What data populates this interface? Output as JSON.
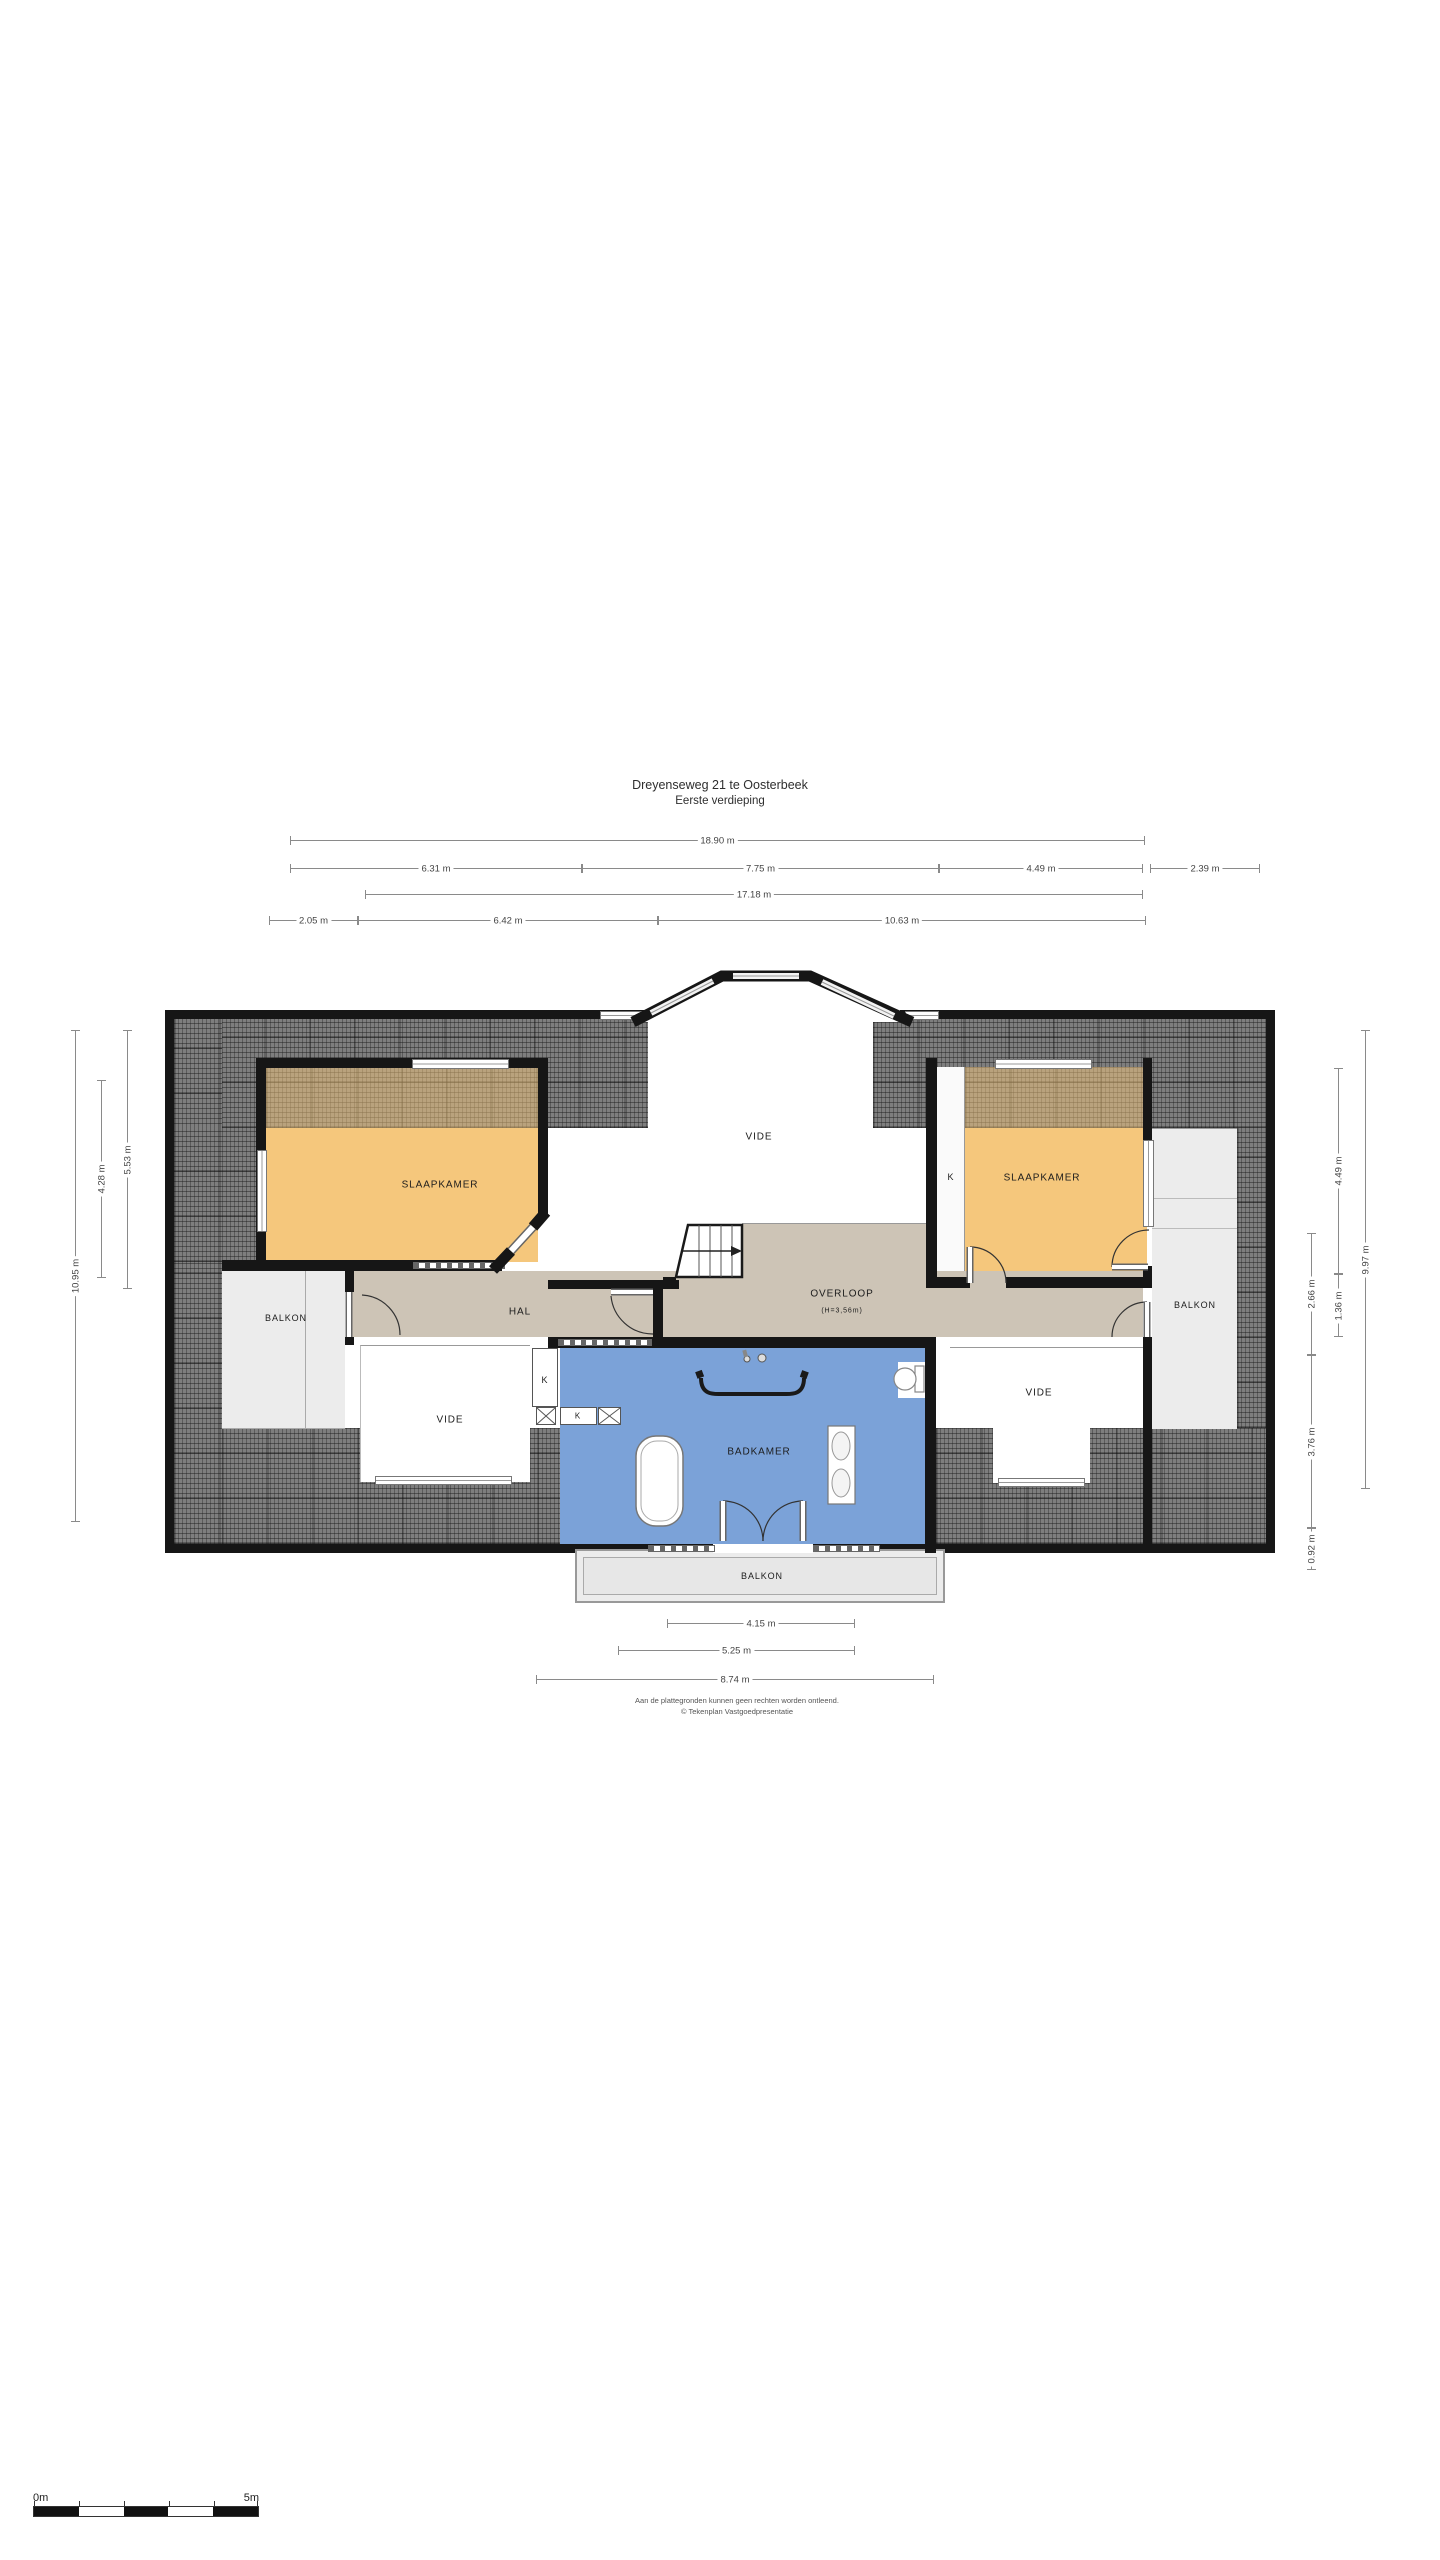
{
  "title": {
    "line1": "Dreyenseweg 21 te Oosterbeek",
    "line2": "Eerste verdieping"
  },
  "colors": {
    "wall": "#161616",
    "bedroom": "#f5c77c",
    "hall": "#cdc4b6",
    "bathroom": "#7ba2d8",
    "balcony": "#ececec",
    "roof_hatch": "#7e7e7e",
    "dim_line": "#8a8a8a",
    "label": "#1c1c1c"
  },
  "floorplan": {
    "room_labels": [
      {
        "name": "room-label-slaapkamer-left",
        "label": "SLAAPKAMER",
        "x": 440,
        "y": 1185
      },
      {
        "name": "room-label-vide-center",
        "label": "VIDE",
        "x": 759,
        "y": 1137
      },
      {
        "name": "room-label-slaapkamer-right",
        "label": "SLAAPKAMER",
        "x": 1042,
        "y": 1178
      },
      {
        "name": "room-label-hal",
        "label": "HAL",
        "x": 520,
        "y": 1312
      },
      {
        "name": "room-label-overloop",
        "label": "OVERLOOP",
        "x": 842,
        "y": 1294
      },
      {
        "name": "room-label-overloop-height",
        "label": "(H=3,56m)",
        "x": 842,
        "y": 1311,
        "size": 7
      },
      {
        "name": "room-label-badkamer",
        "label": "BADKAMER",
        "x": 759,
        "y": 1452
      },
      {
        "name": "room-label-vide-left",
        "label": "VIDE",
        "x": 450,
        "y": 1420
      },
      {
        "name": "room-label-vide-right",
        "label": "VIDE",
        "x": 1039,
        "y": 1393
      },
      {
        "name": "room-label-balkon-left",
        "label": "BALKON",
        "x": 286,
        "y": 1318,
        "size": 9
      },
      {
        "name": "room-label-balkon-right",
        "label": "BALKON",
        "x": 1195,
        "y": 1305,
        "size": 9
      },
      {
        "name": "room-label-balkon-bottom",
        "label": "BALKON",
        "x": 762,
        "y": 1576,
        "size": 9
      },
      {
        "name": "closet-label-right-bedroom",
        "label": "K",
        "x": 951,
        "y": 1177,
        "size": 9
      },
      {
        "name": "closet-label-bathroom-1",
        "label": "K",
        "x": 545,
        "y": 1380,
        "size": 9
      },
      {
        "name": "closet-label-bathroom-2",
        "label": "K",
        "x": 578,
        "y": 1416,
        "size": 8
      }
    ],
    "dimensions": [
      {
        "label": "18.90 m",
        "o": "h",
        "x": 290,
        "y": 840,
        "len": 855
      },
      {
        "label": "6.31 m",
        "o": "h",
        "x": 290,
        "y": 868,
        "len": 292
      },
      {
        "label": "7.75 m",
        "o": "h",
        "x": 582,
        "y": 868,
        "len": 357
      },
      {
        "label": "4.49 m",
        "o": "h",
        "x": 939,
        "y": 868,
        "len": 204
      },
      {
        "label": "2.39 m",
        "o": "h",
        "x": 1150,
        "y": 868,
        "len": 110
      },
      {
        "label": "17.18 m",
        "o": "h",
        "x": 365,
        "y": 894,
        "len": 778
      },
      {
        "label": "2.05 m",
        "o": "h",
        "x": 269,
        "y": 920,
        "len": 89
      },
      {
        "label": "6.42 m",
        "o": "h",
        "x": 358,
        "y": 920,
        "len": 300
      },
      {
        "label": "10.63 m",
        "o": "h",
        "x": 658,
        "y": 920,
        "len": 488
      },
      {
        "label": "10.95 m",
        "o": "v",
        "x": 75,
        "y": 1030,
        "len": 492
      },
      {
        "label": "4.28 m",
        "o": "v",
        "x": 101,
        "y": 1080,
        "len": 198
      },
      {
        "label": "5.53 m",
        "o": "v",
        "x": 127,
        "y": 1030,
        "len": 259
      },
      {
        "label": "4.49 m",
        "o": "v",
        "x": 1338,
        "y": 1068,
        "len": 206
      },
      {
        "label": "1.36 m",
        "o": "v",
        "x": 1338,
        "y": 1274,
        "len": 63
      },
      {
        "label": "2.66 m",
        "o": "v",
        "x": 1311,
        "y": 1233,
        "len": 122
      },
      {
        "label": "3.76 m",
        "o": "v",
        "x": 1311,
        "y": 1355,
        "len": 173
      },
      {
        "label": "0.92 m",
        "o": "v",
        "x": 1311,
        "y": 1528,
        "len": 42
      },
      {
        "label": "9.97 m",
        "o": "v",
        "x": 1365,
        "y": 1030,
        "len": 459
      },
      {
        "label": "4.15 m",
        "o": "h",
        "x": 667,
        "y": 1623,
        "len": 188
      },
      {
        "label": "5.25 m",
        "o": "h",
        "x": 618,
        "y": 1650,
        "len": 237
      },
      {
        "label": "8.74 m",
        "o": "h",
        "x": 536,
        "y": 1679,
        "len": 398
      }
    ]
  },
  "footer": {
    "line1": "Aan de plattegronden kunnen geen rechten worden ontleend.",
    "line2": "© Tekenplan Vastgoedpresentatie"
  },
  "scale_bar": {
    "start": "0m",
    "end": "5m"
  }
}
